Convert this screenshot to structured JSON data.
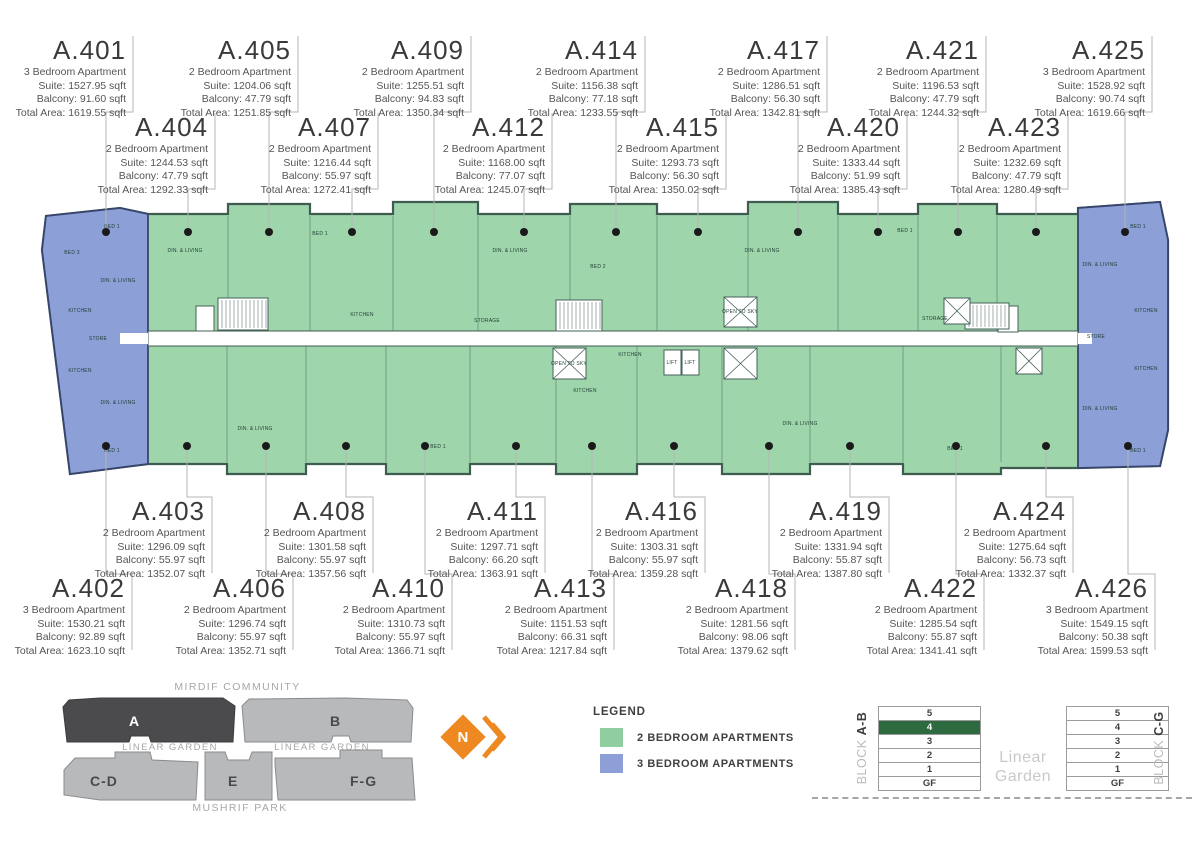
{
  "units": [
    {
      "id": "A.401",
      "row": 1,
      "box_right": 133,
      "dot_x": 106,
      "type": "3 Bedroom Apartment",
      "suite": "Suite: 1527.95 sqft",
      "balcony": "Balcony: 91.60 sqft",
      "total": "Total Area: 1619.55 sqft"
    },
    {
      "id": "A.402",
      "row": 4,
      "box_right": 132,
      "dot_x": 106,
      "type": "3 Bedroom Apartment",
      "suite": "Suite: 1530.21 sqft",
      "balcony": "Balcony: 92.89 sqft",
      "total": "Total Area: 1623.10 sqft"
    },
    {
      "id": "A.403",
      "row": 3,
      "box_right": 212,
      "dot_x": 187,
      "type": "2 Bedroom Apartment",
      "suite": "Suite: 1296.09 sqft",
      "balcony": "Balcony: 55.97 sqft",
      "total": "Total Area: 1352.07 sqft"
    },
    {
      "id": "A.404",
      "row": 2,
      "box_right": 215,
      "dot_x": 188,
      "type": "2 Bedroom Apartment",
      "suite": "Suite: 1244.53 sqft",
      "balcony": "Balcony: 47.79 sqft",
      "total": "Total Area: 1292.33 sqft"
    },
    {
      "id": "A.405",
      "row": 1,
      "box_right": 298,
      "dot_x": 269,
      "type": "2 Bedroom Apartment",
      "suite": "Suite: 1204.06 sqft",
      "balcony": "Balcony: 47.79 sqft",
      "total": "Total Area: 1251.85 sqft"
    },
    {
      "id": "A.406",
      "row": 4,
      "box_right": 293,
      "dot_x": 266,
      "type": "2 Bedroom Apartment",
      "suite": "Suite: 1296.74 sqft",
      "balcony": "Balcony: 55.97 sqft",
      "total": "Total Area: 1352.71 sqft"
    },
    {
      "id": "A.407",
      "row": 2,
      "box_right": 378,
      "dot_x": 352,
      "type": "2 Bedroom Apartment",
      "suite": "Suite: 1216.44 sqft",
      "balcony": "Balcony: 55.97 sqft",
      "total": "Total Area: 1272.41 sqft"
    },
    {
      "id": "A.408",
      "row": 3,
      "box_right": 373,
      "dot_x": 346,
      "type": "2 Bedroom Apartment",
      "suite": "Suite: 1301.58 sqft",
      "balcony": "Balcony: 55.97 sqft",
      "total": "Total Area: 1357.56 sqft"
    },
    {
      "id": "A.409",
      "row": 1,
      "box_right": 471,
      "dot_x": 434,
      "type": "2 Bedroom Apartment",
      "suite": "Suite: 1255.51 sqft",
      "balcony": "Balcony: 94.83 sqft",
      "total": "Total Area: 1350.34 sqft"
    },
    {
      "id": "A.410",
      "row": 4,
      "box_right": 452,
      "dot_x": 425,
      "type": "2 Bedroom Apartment",
      "suite": "Suite: 1310.73 sqft",
      "balcony": "Balcony: 55.97 sqft",
      "total": "Total Area: 1366.71 sqft"
    },
    {
      "id": "A.411",
      "row": 3,
      "box_right": 545,
      "dot_x": 516,
      "type": "2 Bedroom Apartment",
      "suite": "Suite: 1297.71 sqft",
      "balcony": "Balcony: 66.20 sqft",
      "total": "Total Area: 1363.91 sqft"
    },
    {
      "id": "A.412",
      "row": 2,
      "box_right": 552,
      "dot_x": 524,
      "type": "2 Bedroom Apartment",
      "suite": "Suite: 1168.00 sqft",
      "balcony": "Balcony: 77.07 sqft",
      "total": "Total Area: 1245.07 sqft"
    },
    {
      "id": "A.413",
      "row": 4,
      "box_right": 614,
      "dot_x": 592,
      "type": "2 Bedroom Apartment",
      "suite": "Suite: 1151.53 sqft",
      "balcony": "Balcony: 66.31 sqft",
      "total": "Total Area: 1217.84 sqft"
    },
    {
      "id": "A.414",
      "row": 1,
      "box_right": 645,
      "dot_x": 616,
      "type": "2 Bedroom Apartment",
      "suite": "Suite: 1156.38 sqft",
      "balcony": "Balcony: 77.18 sqft",
      "total": "Total Area: 1233.55 sqft"
    },
    {
      "id": "A.415",
      "row": 2,
      "box_right": 726,
      "dot_x": 698,
      "type": "2 Bedroom Apartment",
      "suite": "Suite: 1293.73 sqft",
      "balcony": "Balcony: 56.30 sqft",
      "total": "Total Area: 1350.02 sqft"
    },
    {
      "id": "A.416",
      "row": 3,
      "box_right": 705,
      "dot_x": 674,
      "type": "2 Bedroom Apartment",
      "suite": "Suite: 1303.31 sqft",
      "balcony": "Balcony: 55.97 sqft",
      "total": "Total Area: 1359.28 sqft"
    },
    {
      "id": "A.417",
      "row": 1,
      "box_right": 827,
      "dot_x": 798,
      "type": "2 Bedroom Apartment",
      "suite": "Suite: 1286.51 sqft",
      "balcony": "Balcony: 56.30 sqft",
      "total": "Total Area: 1342.81 sqft"
    },
    {
      "id": "A.418",
      "row": 4,
      "box_right": 795,
      "dot_x": 769,
      "type": "2 Bedroom Apartment",
      "suite": "Suite: 1281.56 sqft",
      "balcony": "Balcony: 98.06 sqft",
      "total": "Total Area: 1379.62 sqft"
    },
    {
      "id": "A.419",
      "row": 3,
      "box_right": 889,
      "dot_x": 850,
      "type": "2 Bedroom Apartment",
      "suite": "Suite: 1331.94 sqft",
      "balcony": "Balcony: 55.87 sqft",
      "total": "Total Area: 1387.80 sqft"
    },
    {
      "id": "A.420",
      "row": 2,
      "box_right": 907,
      "dot_x": 878,
      "type": "2 Bedroom Apartment",
      "suite": "Suite: 1333.44 sqft",
      "balcony": "Balcony: 51.99 sqft",
      "total": "Total Area: 1385.43 sqft"
    },
    {
      "id": "A.421",
      "row": 1,
      "box_right": 986,
      "dot_x": 958,
      "type": "2 Bedroom Apartment",
      "suite": "Suite: 1196.53 sqft",
      "balcony": "Balcony: 47.79 sqft",
      "total": "Total Area: 1244.32 sqft"
    },
    {
      "id": "A.422",
      "row": 4,
      "box_right": 984,
      "dot_x": 956,
      "type": "2 Bedroom Apartment",
      "suite": "Suite: 1285.54 sqft",
      "balcony": "Balcony: 55.87 sqft",
      "total": "Total Area: 1341.41 sqft"
    },
    {
      "id": "A.423",
      "row": 2,
      "box_right": 1068,
      "dot_x": 1036,
      "type": "2 Bedroom Apartment",
      "suite": "Suite: 1232.69 sqft",
      "balcony": "Balcony: 47.79 sqft",
      "total": "Total Area: 1280.49 sqft"
    },
    {
      "id": "A.424",
      "row": 3,
      "box_right": 1073,
      "dot_x": 1046,
      "type": "2 Bedroom Apartment",
      "suite": "Suite: 1275.64 sqft",
      "balcony": "Balcony: 56.73 sqft",
      "total": "Total Area: 1332.37 sqft"
    },
    {
      "id": "A.425",
      "row": 1,
      "box_right": 1152,
      "dot_x": 1125,
      "type": "3 Bedroom Apartment",
      "suite": "Suite: 1528.92 sqft",
      "balcony": "Balcony: 90.74 sqft",
      "total": "Total Area: 1619.66 sqft"
    },
    {
      "id": "A.426",
      "row": 4,
      "box_right": 1155,
      "dot_x": 1128,
      "type": "3 Bedroom Apartment",
      "suite": "Suite: 1549.15 sqft",
      "balcony": "Balcony: 50.38 sqft",
      "total": "Total Area: 1599.53 sqft"
    }
  ],
  "plan": {
    "room_labels": [
      {
        "t": "BED 1",
        "x": 112,
        "y": 228
      },
      {
        "t": "BED 3",
        "x": 72,
        "y": 254
      },
      {
        "t": "DIN. & LIVING",
        "x": 118,
        "y": 282
      },
      {
        "t": "KITCHEN",
        "x": 80,
        "y": 312
      },
      {
        "t": "STORE",
        "x": 98,
        "y": 340
      },
      {
        "t": "KITCHEN",
        "x": 80,
        "y": 372
      },
      {
        "t": "DIN. & LIVING",
        "x": 118,
        "y": 404
      },
      {
        "t": "BED 1",
        "x": 112,
        "y": 452
      },
      {
        "t": "DIN. & LIVING",
        "x": 185,
        "y": 252
      },
      {
        "t": "BED 1",
        "x": 320,
        "y": 235
      },
      {
        "t": "KITCHEN",
        "x": 362,
        "y": 316
      },
      {
        "t": "DIN. & LIVING",
        "x": 510,
        "y": 252
      },
      {
        "t": "BED 2",
        "x": 598,
        "y": 268
      },
      {
        "t": "STORAGE",
        "x": 487,
        "y": 322
      },
      {
        "t": "KITCHEN",
        "x": 630,
        "y": 356
      },
      {
        "t": "DIN. & LIVING",
        "x": 762,
        "y": 252
      },
      {
        "t": "BED 1",
        "x": 905,
        "y": 232
      },
      {
        "t": "STORAGE",
        "x": 935,
        "y": 320
      },
      {
        "t": "DIN. & LIVING",
        "x": 255,
        "y": 430
      },
      {
        "t": "BED 1",
        "x": 438,
        "y": 448
      },
      {
        "t": "KITCHEN",
        "x": 585,
        "y": 392
      },
      {
        "t": "DIN. & LIVING",
        "x": 800,
        "y": 425
      },
      {
        "t": "BED 1",
        "x": 955,
        "y": 450
      },
      {
        "t": "BED 1",
        "x": 1138,
        "y": 228
      },
      {
        "t": "DIN. & LIVING",
        "x": 1100,
        "y": 266
      },
      {
        "t": "KITCHEN",
        "x": 1146,
        "y": 312
      },
      {
        "t": "STORE",
        "x": 1096,
        "y": 338
      },
      {
        "t": "KITCHEN",
        "x": 1146,
        "y": 370
      },
      {
        "t": "DIN. & LIVING",
        "x": 1100,
        "y": 410
      },
      {
        "t": "BED 1",
        "x": 1138,
        "y": 452
      },
      {
        "t": "LIFT",
        "x": 672,
        "y": 364
      },
      {
        "t": "LIFT",
        "x": 690,
        "y": 364
      },
      {
        "t": "OPEN TO SKY",
        "x": 740,
        "y": 313
      },
      {
        "t": "OPEN TO SKY",
        "x": 569,
        "y": 365
      }
    ]
  },
  "legend": {
    "title": "LEGEND",
    "items": [
      {
        "label": "2 BEDROOM APARTMENTS",
        "color": "#8fcf9f"
      },
      {
        "label": "3 BEDROOM APARTMENTS",
        "color": "#8d9fd6"
      }
    ]
  },
  "site_plan": {
    "top_label": "MIRDIF COMMUNITY",
    "bottom_label": "MUSHRIF PARK",
    "garden_left": "LINEAR GARDEN",
    "garden_right": "LINEAR GARDEN",
    "blocks": [
      {
        "label": "A",
        "selected": true
      },
      {
        "label": "B",
        "selected": false
      },
      {
        "label": "C-D",
        "selected": false
      },
      {
        "label": "E",
        "selected": false
      },
      {
        "label": "F-G",
        "selected": false
      }
    ]
  },
  "north_label": "N",
  "linear_garden": "Linear Garden",
  "floor_selectors": [
    {
      "block_word": "BLOCK",
      "name": "A-B",
      "floors": [
        "5",
        "4",
        "3",
        "2",
        "1",
        "GF"
      ],
      "selected": "4"
    },
    {
      "block_word": "BLOCK",
      "name": "C-G",
      "floors": [
        "5",
        "4",
        "3",
        "2",
        "1",
        "GF"
      ],
      "selected": ""
    }
  ],
  "colors": {
    "green": "#9ed5ab",
    "blue": "#8c9fd7",
    "selected_floor": "#2d6a3f",
    "orange": "#ee8922",
    "legend_green": "#8fcf9f",
    "legend_blue": "#8d9fd6"
  }
}
